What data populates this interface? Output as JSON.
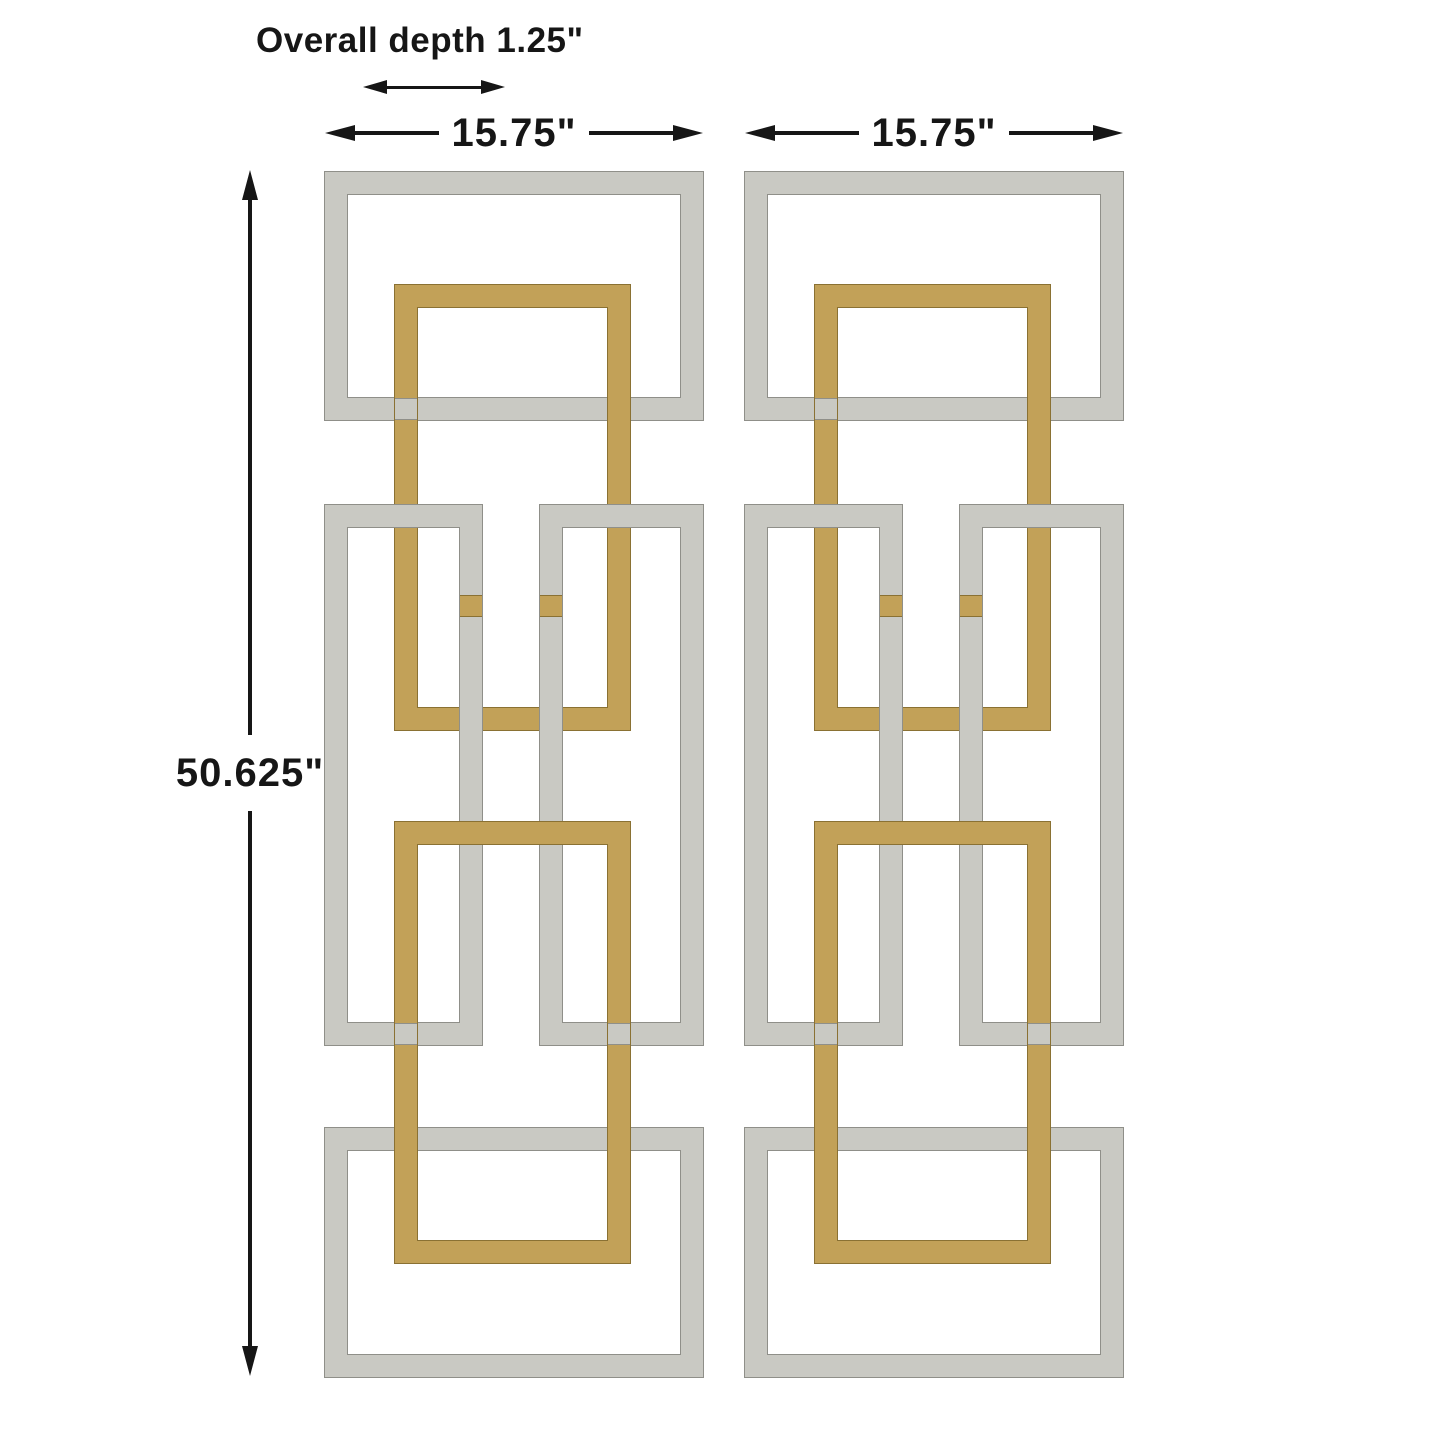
{
  "diagram": {
    "depth_label": "Overall depth 1.25\"",
    "width_label_left": "15.75\"",
    "width_label_right": "15.75\"",
    "height_label": "50.625\"",
    "panel_count": 2,
    "finishes": [
      "silver",
      "gold"
    ]
  },
  "colors": {
    "background": "#ffffff",
    "line": "#161616",
    "silver": "#c9c9c3",
    "silver_edge": "#8f8f89",
    "gold": "#c2a158",
    "gold_edge": "#8a7133"
  }
}
